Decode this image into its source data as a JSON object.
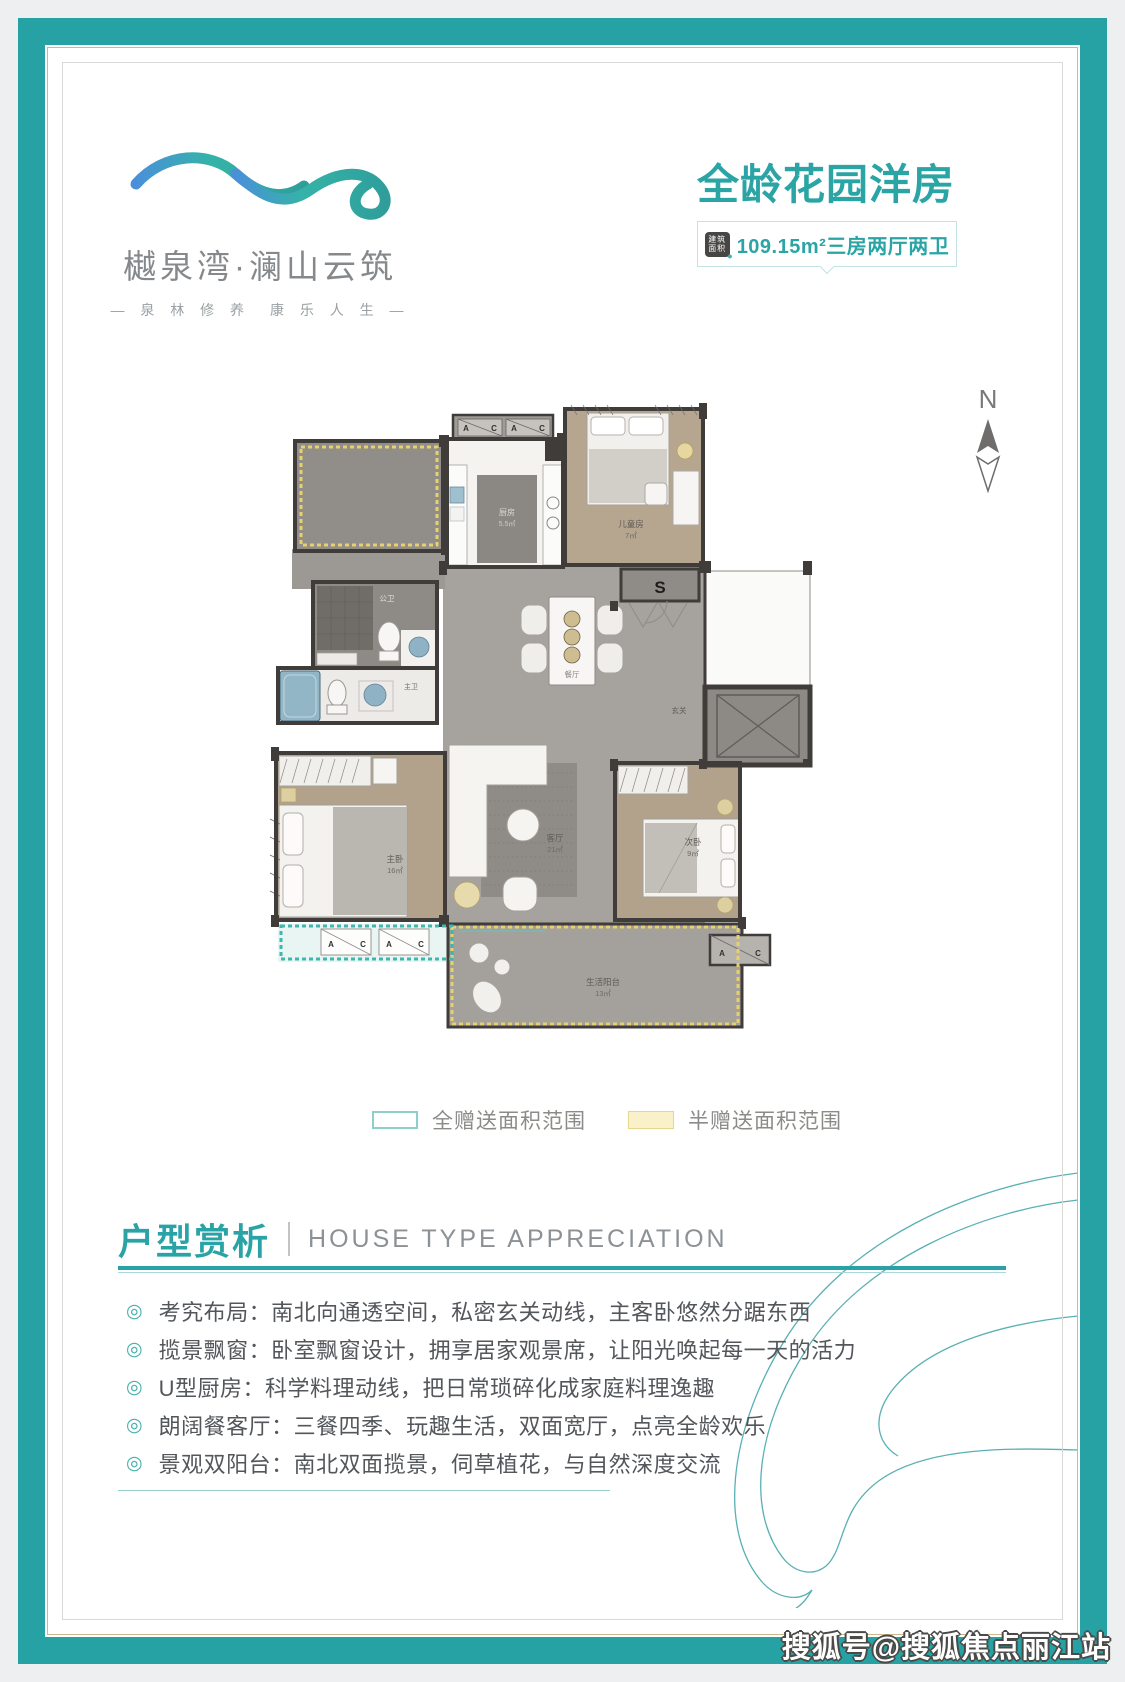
{
  "brand": {
    "name": "樾泉湾·澜山云筑",
    "tagline": "— 泉 林 修 养　康 乐 人 生 —"
  },
  "header": {
    "title": "全龄花园洋房",
    "badge_icon_label": "建筑面积",
    "badge_text": "109.15m²三房两厅两卫"
  },
  "compass": {
    "north": "N"
  },
  "floorplan": {
    "stair": "S",
    "ac": {
      "a": "A",
      "c": "C"
    },
    "rooms": {
      "kitchen": {
        "name": "厨房",
        "area": "5.5㎡"
      },
      "kids": {
        "name": "儿童房",
        "area": "7㎡"
      },
      "dining": {
        "name": "餐厅"
      },
      "living": {
        "name": "客厅",
        "area": "21㎡"
      },
      "master": {
        "name": "主卧",
        "area": "16㎡"
      },
      "second": {
        "name": "次卧",
        "area": "9㎡"
      },
      "bath_public": {
        "name": "公卫"
      },
      "bath_master": {
        "name": "主卫"
      },
      "entry": {
        "name": "玄关"
      },
      "balcony": {
        "name": "生活阳台",
        "area": "13㎡"
      }
    }
  },
  "legend": {
    "full": "全赠送面积范围",
    "half": "半赠送面积范围"
  },
  "section": {
    "title_cn": "户型赏析",
    "title_en": "HOUSE TYPE APPRECIATION",
    "bullets": [
      "考究布局：南北向通透空间，私密玄关动线，主客卧悠然分踞东西",
      "揽景飘窗：卧室飘窗设计，拥享居家观景席，让阳光唤起每一天的活力",
      "U型厨房：科学料理动线，把日常琐碎化成家庭料理逸趣",
      "朗阔餐客厅：三餐四季、玩趣生活，双面宽厅，点亮全龄欢乐",
      "景观双阳台：南北双面揽景，伺草植花，与自然深度交流"
    ]
  },
  "watermark": "搜狐号@搜狐焦点丽江站",
  "colors": {
    "accent_teal": "#2aa3a6",
    "frame_teal": "#26a2a4",
    "gift_full_dash": "#3fb6ae",
    "gift_half_dash": "#e8d06e",
    "wall": "#3f3c39"
  }
}
